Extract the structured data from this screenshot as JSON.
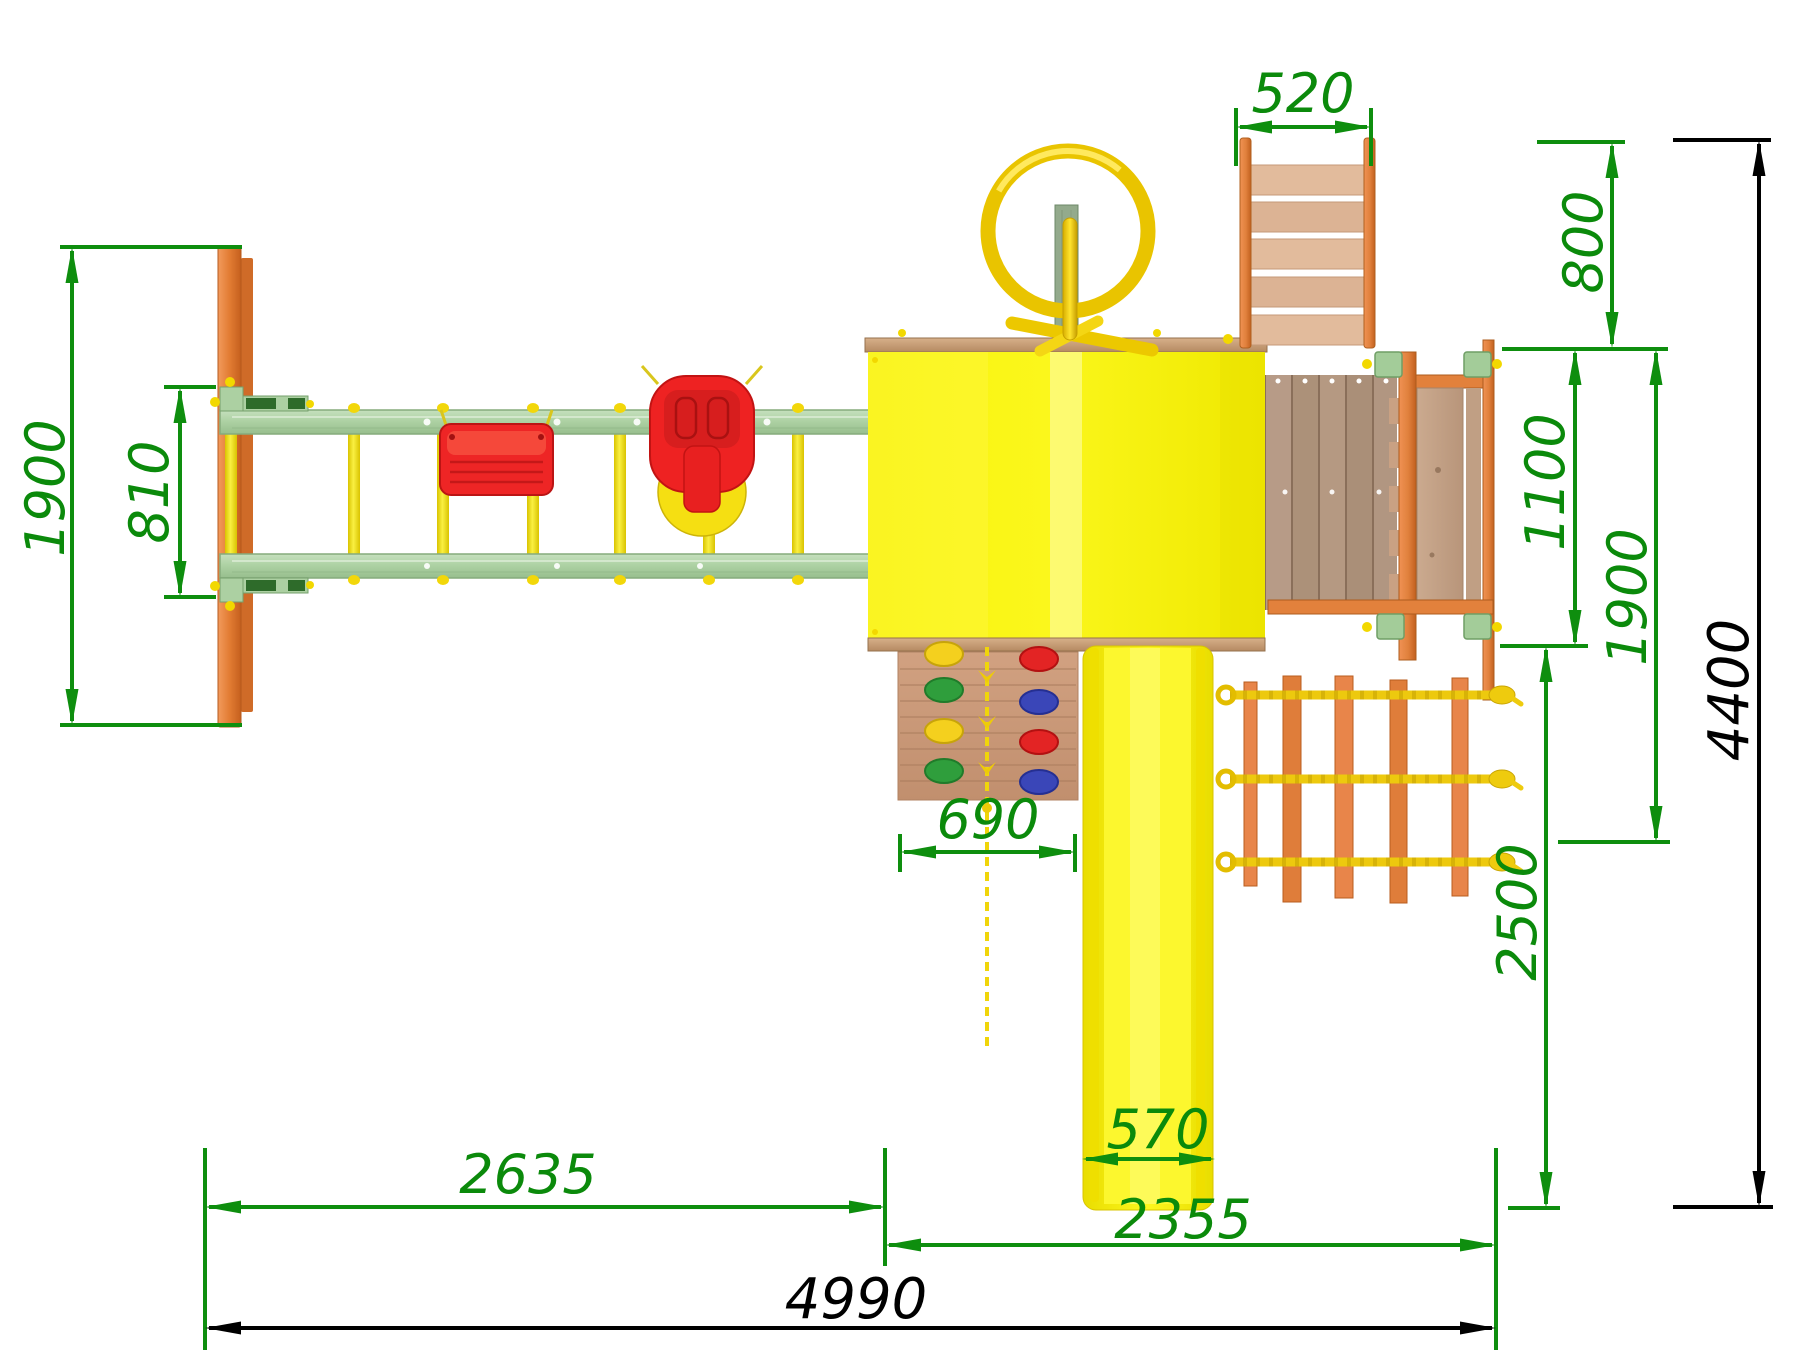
{
  "dimensions": {
    "left_overall": "1900",
    "swing_bay": "810",
    "ladder_width": "520",
    "ladder_depth": "800",
    "platform_depth": "1100",
    "right_overall": "1900",
    "rear_depth": "2500",
    "total_depth": "4400",
    "climbing_wall_width": "690",
    "slide_width": "570",
    "left_section_length": "2635",
    "right_section_length": "2355",
    "total_length": "4990"
  },
  "colors": {
    "dimension_accent": "#0E8E0E",
    "dimension_secondary": "#000000",
    "tower_yellow": "#F7F000",
    "slide_yellow": "#FBF500",
    "beam_green": "#AED2A4",
    "wood_orange": "#E2813C",
    "swing_red": "#ED2424",
    "deck_wood": "#B69A86",
    "hold_yellow": "#F4D01E",
    "hold_green": "#2F9E3C",
    "hold_red": "#E32424",
    "hold_blue": "#3A46B8",
    "rope_yellow": "#EDC90E"
  }
}
